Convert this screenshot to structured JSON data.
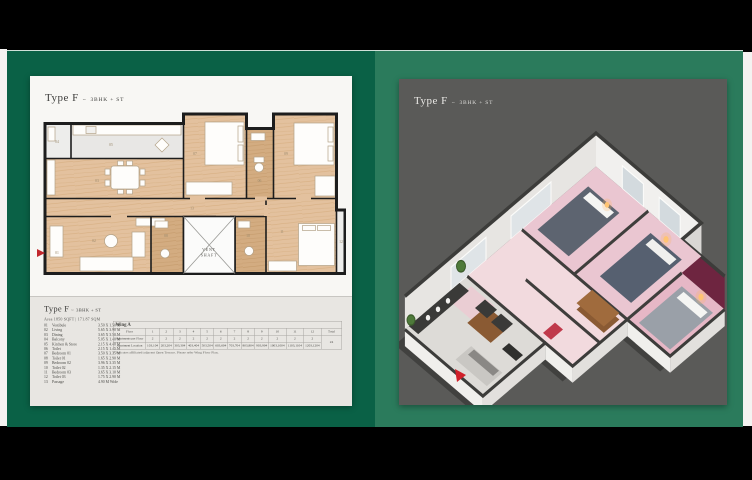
{
  "accent_colors": {
    "panel_left_green": "#0a6146",
    "panel_right_green": "#2b7b5c",
    "card_left_bg": "#f8f7f4",
    "card_right_bg": "#5a5a58",
    "entry_arrow_red": "#c1272d"
  },
  "left_panel": {
    "card_title": {
      "prefix": "Type F",
      "tilde": "~",
      "suffix": "3BHK + ST"
    },
    "plan": {
      "vent_shaft_line1": "VENT",
      "vent_shaft_line2": "SHAFT"
    },
    "details": {
      "title_prefix": "Type F",
      "title_tilde": "~",
      "title_suffix": "3BHK + ST",
      "area_line": "Area 1850 SQFT | 171.87 SQM",
      "rooms": [
        {
          "no": "01",
          "name": "Vestibule",
          "dim": "3.50 X 1.50 M"
        },
        {
          "no": "02",
          "name": "Living",
          "dim": "5.65 X 3.90 M"
        },
        {
          "no": "03",
          "name": "Dining",
          "dim": "3.65 X 3.50 M"
        },
        {
          "no": "04",
          "name": "Balcony",
          "dim": "5.05 X 1.40 M"
        },
        {
          "no": "05",
          "name": "Kitchen & Store",
          "dim": "2.15 X 4.40 M"
        },
        {
          "no": "06",
          "name": "Toilet",
          "dim": "2.15 X 1.45 M"
        },
        {
          "no": "07",
          "name": "Bedroom 01",
          "dim": "3.50 X 3.35 M"
        },
        {
          "no": "08",
          "name": "Toilet 01",
          "dim": "1.65 X 2.90 M"
        },
        {
          "no": "09",
          "name": "Bedroom 02",
          "dim": "3.96 X 3.35 M"
        },
        {
          "no": "10",
          "name": "Toilet 02",
          "dim": "1.35 X 2.15 M"
        },
        {
          "no": "11",
          "name": "Bedroom 03",
          "dim": "3.65 X 3.10 M"
        },
        {
          "no": "12",
          "name": "Toilet 03",
          "dim": "1.75 X 2.90 M"
        },
        {
          "no": "13",
          "name": "Passage",
          "dim": "4.90 M Wide"
        }
      ],
      "wing_table": {
        "title": "Wing A",
        "row_labels": [
          "Floor",
          "Apartments per Floor",
          "Apartment Location"
        ],
        "floors": [
          "1",
          "2",
          "3",
          "4",
          "5",
          "6",
          "7",
          "8",
          "9",
          "10",
          "11",
          "12"
        ],
        "apartments_per_floor": [
          "2",
          "2",
          "2",
          "2",
          "2",
          "2",
          "2",
          "2",
          "2",
          "2",
          "2",
          "2"
        ],
        "locations": [
          "103,104",
          "203,204",
          "303,304",
          "403,404",
          "503,504",
          "603,604",
          "703,704",
          "803,804",
          "903,904",
          "1003,1004",
          "1103,1104",
          "1203,1204"
        ],
        "total_label": "Total",
        "total_value": "24",
        "footnote": "* Indicates affiliated/adjacent Open Terrace. Please refer Wing Floor Plan."
      }
    }
  },
  "right_panel": {
    "card_title": {
      "prefix": "Type F",
      "tilde": "~",
      "suffix": "3BHK + ST"
    }
  }
}
